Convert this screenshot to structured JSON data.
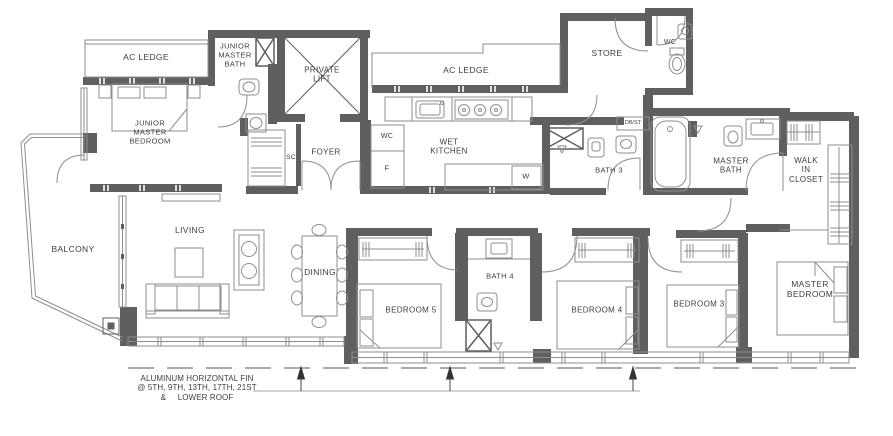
{
  "drawing": {
    "type": "apartment-floor-plan",
    "colors": {
      "wall": "#5f5f5f",
      "thin_line": "#8e8e8e",
      "light_line": "#b0b0b0",
      "text": "#3f3f3f",
      "background": "#ffffff",
      "arrow": "#333333"
    },
    "rooms": {
      "ac_ledge_left": "AC LEDGE",
      "junior_master_bath": "JUNIOR\nMASTER\nBATH",
      "private_lift": "PRIVATE\nLIFT",
      "junior_master_bedroom": "JUNIOR\nMASTER\nBEDROOM",
      "ac_ledge_mid": "AC LEDGE",
      "store": "STORE",
      "wc_store": "WC",
      "sc": "SC",
      "foyer": "FOYER",
      "wc_kitchen": "WC",
      "fridge": "F",
      "wet_kitchen": "WET\nKITCHEN",
      "washer": "W",
      "bath3": "BATH 3",
      "dbst": "DB/ST",
      "master_bath": "MASTER\nBATH",
      "walk_in_closet": "WALK\nIN\nCLOSET",
      "balcony": "BALCONY",
      "living": "LIVING",
      "dining": "DINING",
      "bedroom5": "BEDROOM 5",
      "bath4": "BATH 4",
      "bedroom4": "BEDROOM 4",
      "bedroom3": "BEDROOM 3",
      "master_bedroom": "MASTER\nBEDROOM"
    },
    "annotation": {
      "fin_note": "ALUMINUM HORIZONTAL FIN\n@ 5TH, 9TH, 13TH, 17TH, 21ST\n&     LOWER ROOF"
    }
  }
}
